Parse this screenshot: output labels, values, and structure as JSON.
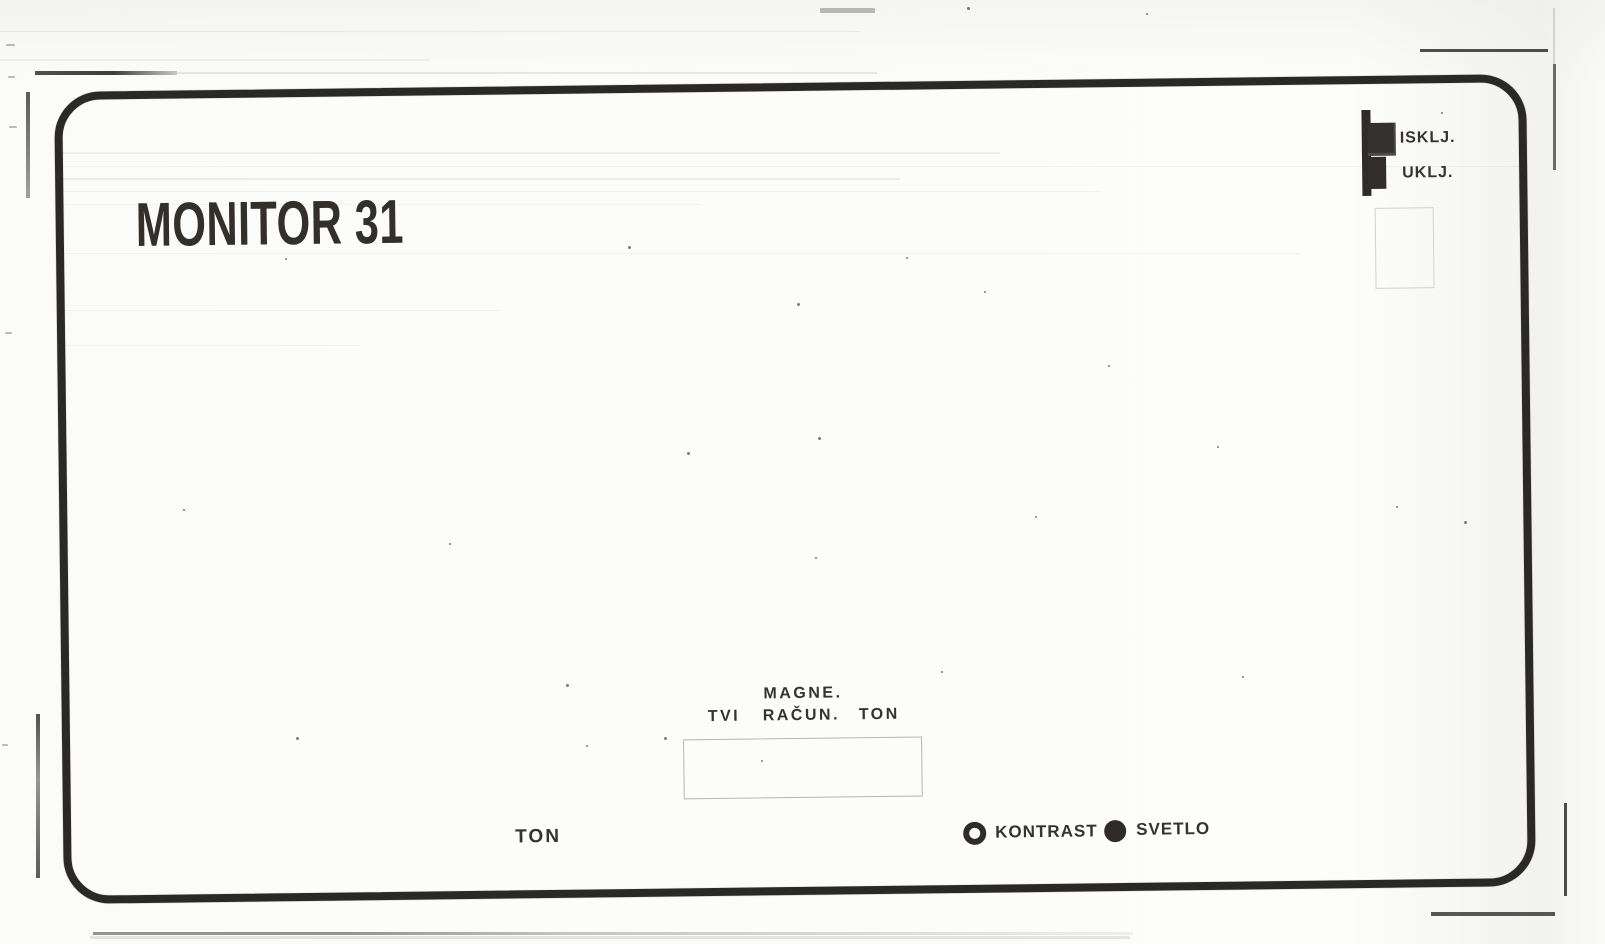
{
  "panel": {
    "title": "MONITOR 31"
  },
  "power_switch": {
    "off_label": "ISKLJ.",
    "on_label": "UKLJ."
  },
  "input_selector": {
    "top_label": "MAGNE.",
    "row_labels": [
      "TVI",
      "RAČUN.",
      "TON"
    ]
  },
  "bottom_controls": {
    "volume_label": "TON",
    "contrast_label": "KONTRAST",
    "brightness_label": "SVETLO"
  },
  "colors": {
    "ink": "#302d29",
    "panel_border": "#2b2927",
    "paper": "#fcfcfa",
    "faint_outline": "#c9c7c0"
  }
}
